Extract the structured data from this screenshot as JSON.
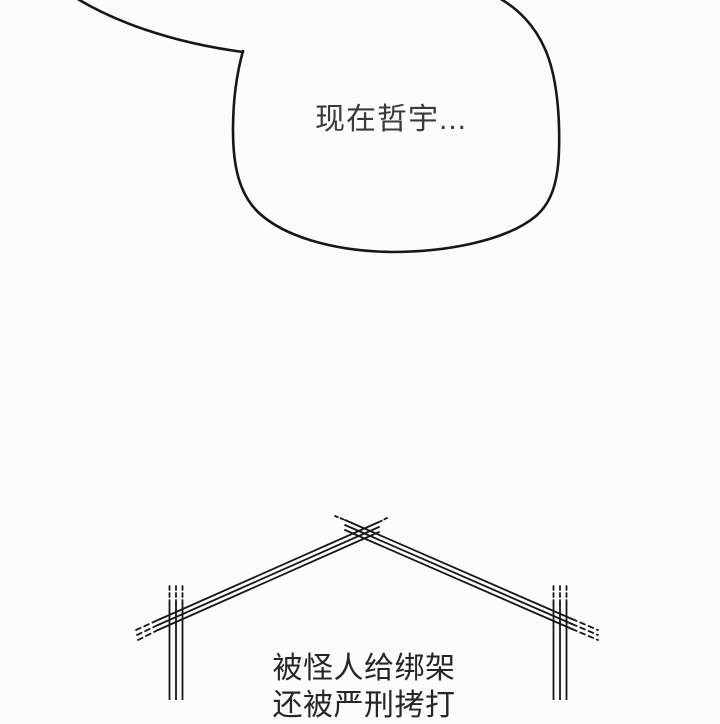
{
  "bubble": {
    "text": "现在哲宇..."
  },
  "narration": {
    "line1": "被怪人给绑架",
    "line2": "还被严刑拷打"
  },
  "colors": {
    "background": "#fcfcfc",
    "line_art": "#171717",
    "bubble_text": "#3a3a3a",
    "narration_text": "#262626"
  }
}
